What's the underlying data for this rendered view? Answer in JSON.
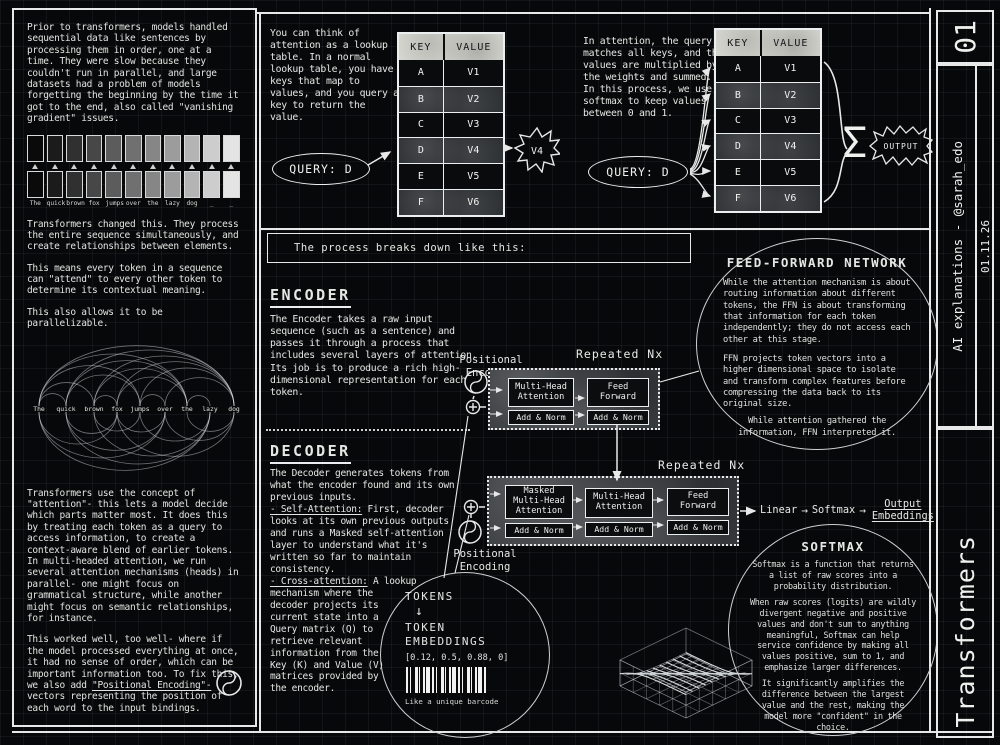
{
  "sidebar": {
    "issue": "01",
    "byline": "AI explanations - @sarah_edo",
    "date": "01.11.26",
    "title": "Transformers"
  },
  "icons": {
    "arrow": "→",
    "down_arrow": "↓",
    "sigma": "Σ"
  },
  "left_column": {
    "para1": "Prior to transformers, models handled sequential data like sentences by processing them in order, one at a time. They were slow because they couldn't run in parallel, and large datasets had a problem of models forgetting the beginning by the time it got to the end, also called \"vanishing gradient\" issues.",
    "token_words": [
      "The",
      "quick",
      "brown",
      "fox",
      "jumps",
      "over",
      "the",
      "lazy",
      "dog",
      "_",
      "_"
    ],
    "para2": "Transformers changed this. They process the entire sequence simultaneously, and create relationships between elements.",
    "para3": "This means every token in a sequence can \"attend\" to every other token to determine its contextual meaning.",
    "para4": "This also allows it to be parallelizable.",
    "arc_words": [
      "The",
      "quick",
      "brown",
      "fox",
      "jumps",
      "over",
      "the",
      "lazy",
      "dog"
    ],
    "para5": "Transformers use the concept of \"attention\"- this lets a model decide which parts matter most. It does this by treating each token as a query to access information, to create a context-aware blend of earlier tokens.\nIn multi-headed attention, we run several attention mechanisms (heads) in parallel- one might focus on grammatical structure, while another might focus on semantic relationships, for instance.",
    "para6_pre": "This worked well, too well- where if the model processed everything at once, it had no sense of order, which can be important information too. To fix this, we also add ",
    "para6_link": "\"Positional Encoding\"-",
    "para6_post": " vectors representing the position of each word to the input bindings."
  },
  "lookup": {
    "text": "You can think of attention as a lookup table. In a normal lookup table, you have keys that map to values, and you query a key to return the value.",
    "query_label": "QUERY:  D",
    "result": "V4",
    "table": {
      "headers": [
        "KEY",
        "VALUE"
      ],
      "rows": [
        [
          "A",
          "V1"
        ],
        [
          "B",
          "V2"
        ],
        [
          "C",
          "V3"
        ],
        [
          "D",
          "V4"
        ],
        [
          "E",
          "V5"
        ],
        [
          "F",
          "V6"
        ]
      ]
    }
  },
  "attention": {
    "text": "In attention, the query matches all keys, and the values are multiplied by the weights and summed. In this process, we use softmax to keep values between 0 and 1.",
    "query_label": "QUERY:  D",
    "output_label": "OUTPUT",
    "table": {
      "headers": [
        "KEY",
        "VALUE"
      ],
      "rows": [
        [
          "A",
          "V1"
        ],
        [
          "B",
          "V2"
        ],
        [
          "C",
          "V3"
        ],
        [
          "D",
          "V4"
        ],
        [
          "E",
          "V5"
        ],
        [
          "F",
          "V6"
        ]
      ]
    }
  },
  "process": {
    "banner": "The process breaks down like this:"
  },
  "encoder": {
    "heading": "ENCODER",
    "body": "The Encoder takes a raw input sequence (such as a sentence) and passes it through a process that includes several layers of attention. Its job is to produce a rich high-dimensional representation for each token.",
    "repeated_label": "Repeated Nx",
    "positional_label": "Positional Encoding",
    "blocks": [
      "Multi-Head Attention",
      "Feed Forward"
    ],
    "addnorm": "Add & Norm"
  },
  "decoder": {
    "heading": "DECODER",
    "body_intro": "The Decoder generates tokens from what the encoder found and its own previous inputs.",
    "self_label": "- Self-Attention:",
    "self_text": " First, decoder looks at its own previous outputs and runs a Masked self-attention layer to understand what it's written so far to maintain consistency.",
    "cross_label": "- Cross-attention:",
    "cross_text": " A lookup mechanism where the decoder projects its current state into a Query matrix (Q) to retrieve relevant information from the Key (K) and Value (V) matrices provided by the encoder.",
    "repeated_label": "Repeated Nx",
    "positional_label": "Positional Encoding",
    "blocks": [
      "Masked Multi-Head Attention",
      "Multi-Head Attention",
      "Feed Forward"
    ],
    "addnorm": "Add & Norm",
    "output_chain": [
      "Linear",
      "Softmax",
      "Output Embeddings"
    ]
  },
  "ffn": {
    "heading": "FEED-FORWARD NETWORK",
    "para1": "While the attention mechanism is about routing information about different tokens, the FFN is about transforming that information for each token independently; they do not access each other at this stage.",
    "para2": "FFN projects token vectors into a higher dimensional space to isolate and transform complex features before compressing the data back to its original size.",
    "para3": "While attention gathered the information, FFN interpreted it."
  },
  "softmax": {
    "heading": "SOFTMAX",
    "para1": "Softmax is a function that returns a list of raw scores into a probability distribution.",
    "para2": "When raw scores (logits) are wildly divergent negative and positive values and don't sum to anything meaningful, Softmax can help service confidence by making all values positive, sum to 1, and emphasize larger differences.",
    "para3": "It significantly amplifies the difference between the largest value and the rest, making the model more \"confident\" in the choice."
  },
  "tokens": {
    "tokens_label": "TOKENS",
    "embeddings_label": "TOKEN EMBEDDINGS",
    "vector": "[0.12, 0.5, 0.88, 0]",
    "caption": "Like a unique barcode"
  }
}
